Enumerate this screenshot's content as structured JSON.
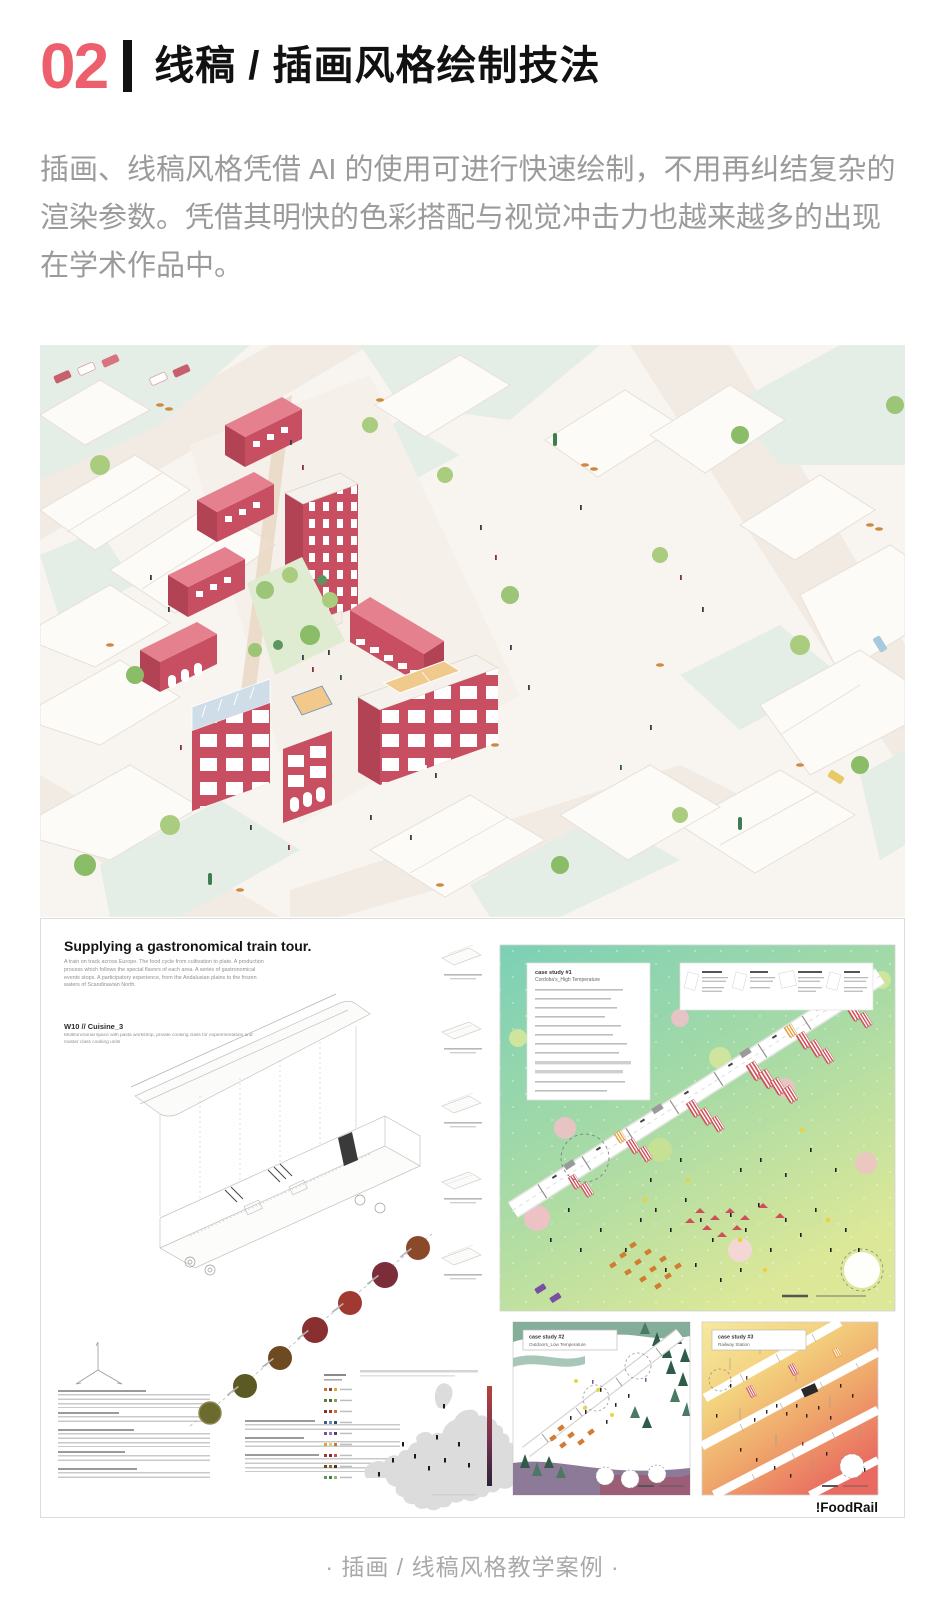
{
  "header": {
    "number": "02",
    "title": "线稿 / 插画风格绘制技法"
  },
  "intro": "插画、线稿风格凭借 AI 的使用可进行快速绘制，不用再纠结复杂的渲染参数。凭借其明快的色彩搭配与视觉冲击力也越来越多的出现在学术作品中。",
  "board": {
    "title": "Supplying a gastronomical train tour.",
    "abstract": "A train on track across Europe. The food cycle from cultivation to plate. A production process which follows the special flavors of each area. A series of gastronomical events stops. A participatory experience, from the Andalusian plains to the frozen waters of Scandinavian North.",
    "module": {
      "label": "W10 // Cuisine_3",
      "desc": "Multifunctional space with pasta workshop, private cooking class for experimentation and master class cooking units"
    },
    "case_studies": [
      {
        "id": "case study #1",
        "name": "Cordoba's_High Temperature"
      },
      {
        "id": "case study #2",
        "name": "Outdoors_Low Temperature"
      },
      {
        "id": "case study #3",
        "name": "Railway Station"
      }
    ],
    "logo": "!FoodRail"
  },
  "caption": "· 插画 / 线稿风格教学案例 ·",
  "colors": {
    "accent": "#ee5f6d",
    "building_red": "#c84e62",
    "roof_pink": "#e5808f",
    "panel_green_top": "#7cd0b6",
    "panel_green_bottom": "#dce898",
    "body_gray": "#9b9b9b"
  }
}
